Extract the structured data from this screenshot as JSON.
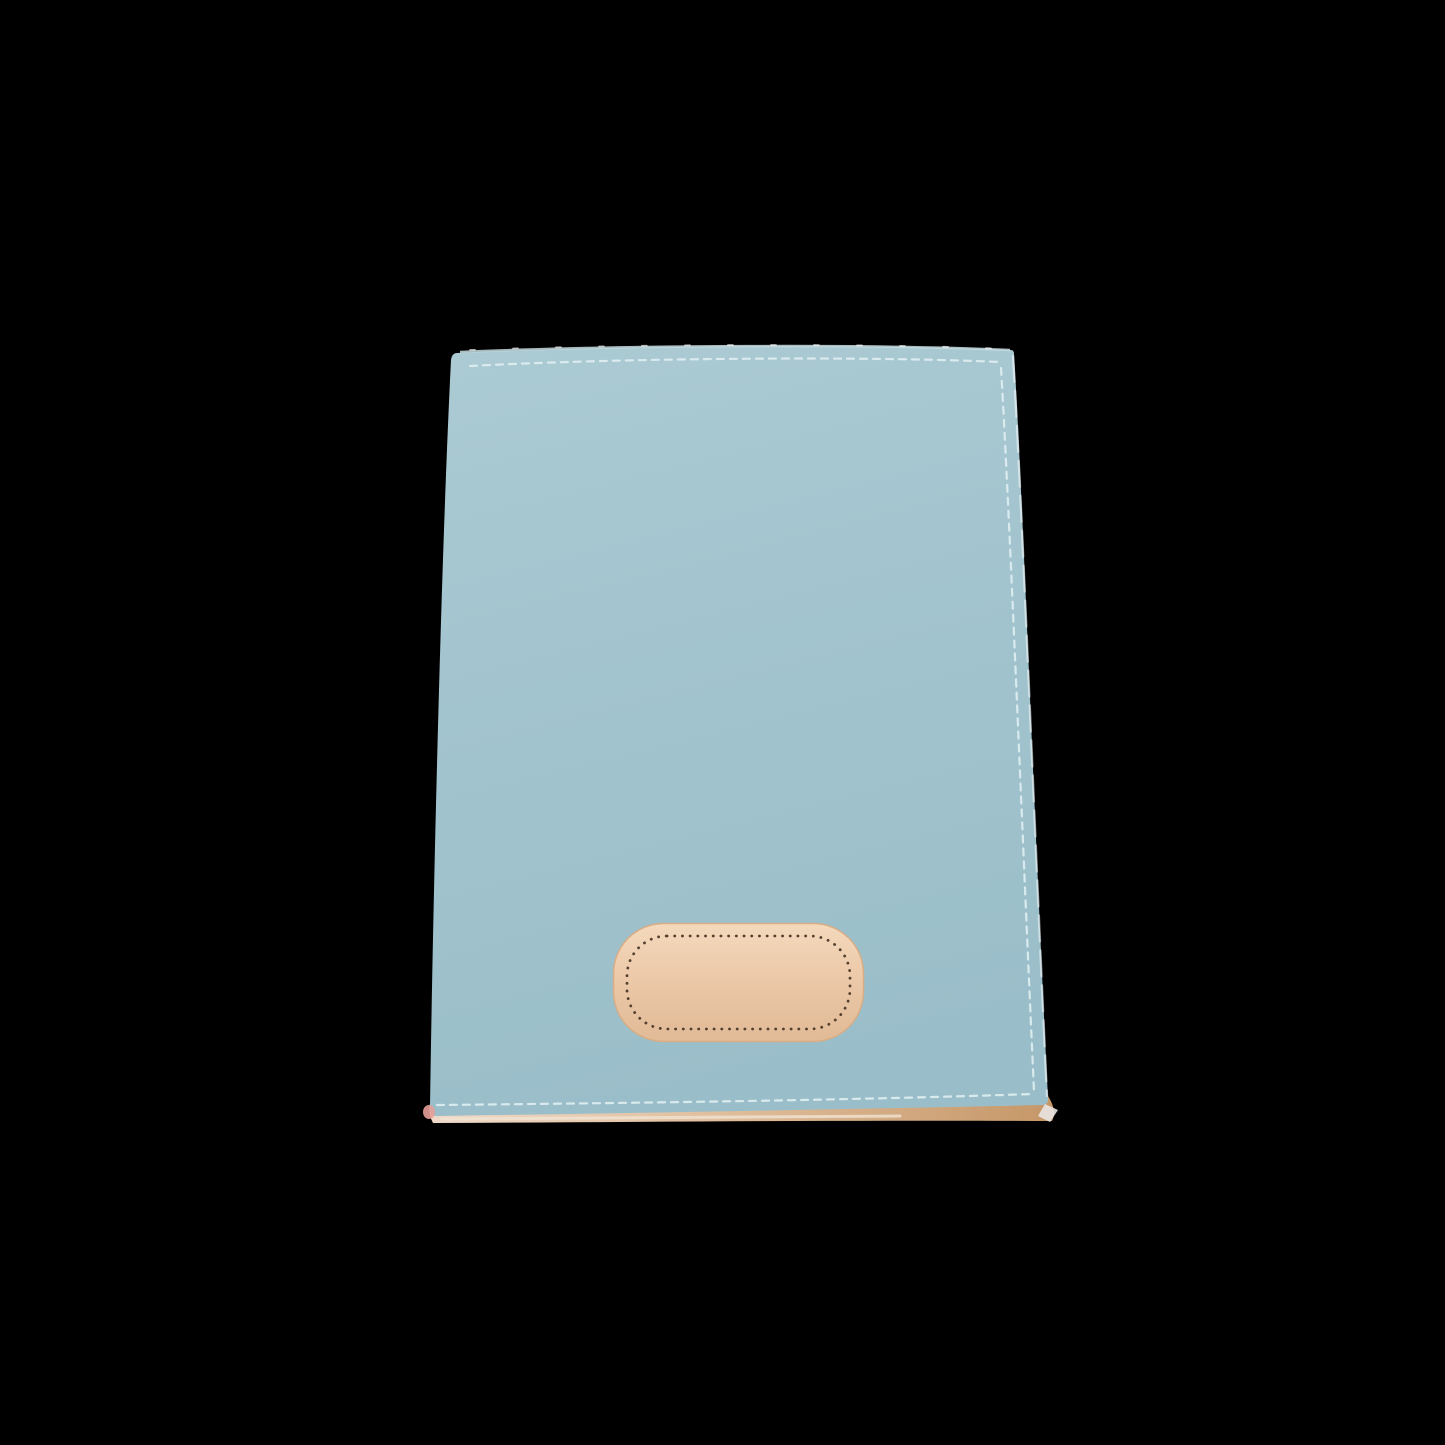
{
  "scene": {
    "type": "product-photo",
    "background_color": "#000000",
    "subject": "Light blue folio cover with natural leather patch"
  },
  "folio": {
    "cover_color_top": "#abcad3",
    "cover_color_mid": "#a1c3cd",
    "cover_color_bottom": "#9abec9",
    "stitch_color": "#dcecef",
    "top_edge_sheen": "#c5dce1",
    "top_edge_glint": "#ffffff",
    "right_edge_highlight": "#ffffff",
    "bottom_edge": {
      "leather_light": "#efd9c8",
      "leather_mid": "#e0bf9e",
      "leather_dark": "#c69768",
      "cream_highlight": "#f0e3d2",
      "pink_accent": "#e59e97",
      "corner_glint": "#e9e6e2"
    },
    "patch": {
      "leather_top": "#f4d9bc",
      "leather_mid": "#ecc9a9",
      "leather_bottom": "#e1ba96",
      "edge_tint": "#d8ad85",
      "stitch_dot_color": "#55402f"
    }
  }
}
